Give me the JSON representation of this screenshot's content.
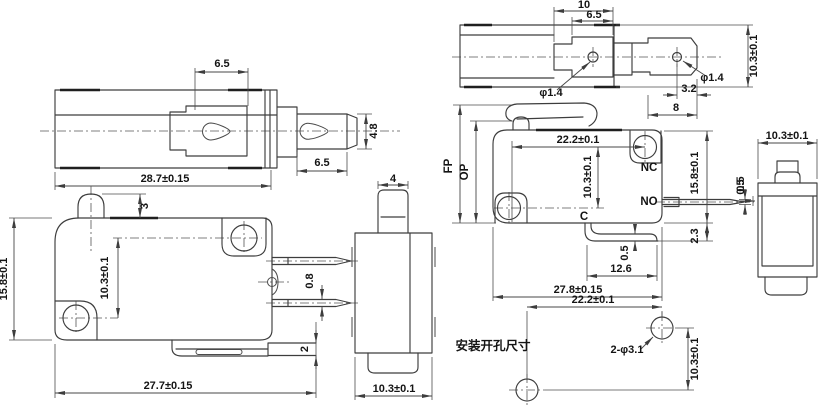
{
  "meta": {
    "type": "engineering-dimension-drawing",
    "subject": "micro switch (plunger and hinge-lever versions) multi-view drawing",
    "background_color": "#ffffff",
    "line_color": "#3d3d3d",
    "text_color": "#141414"
  },
  "views": {
    "plunger_top": {
      "dim_actuator_width": "6.5",
      "dim_shaft_height": "4.8",
      "dim_shaft_length": "6.5",
      "dim_body_length": "28.7±0.15"
    },
    "plunger_side": {
      "dim_button_height": "3",
      "dim_body_height": "15.8±0.1",
      "dim_hole_spacing": "10.3±0.1",
      "dim_terminal_thickness": "0.8",
      "dim_tab_thickness": "2",
      "dim_body_length": "27.7±0.15"
    },
    "plunger_end": {
      "dim_button_width": "4",
      "dim_body_width": "10.3±0.1"
    },
    "lever_top": {
      "dim_hinge_width": "10",
      "dim_hinge_inner_width": "6.5",
      "dim_hole_left": "φ1.4",
      "dim_hole_right": "φ1.4",
      "dim_hole_to_end": "3.2",
      "dim_arm_length": "8",
      "dim_body_width": "10.3±0.1"
    },
    "lever_side": {
      "label_fp": "FP",
      "label_op": "OP",
      "label_nc": "NC",
      "label_no": "NO",
      "label_c": "C",
      "dim_hole_spacing_h": "22.2±0.1",
      "dim_hole_spacing_v": "10.3±0.1",
      "dim_body_height": "15.8±0.1",
      "dim_terminal_thickness": "0.5",
      "dim_bracket_drop": "2.3",
      "dim_bracket_thickness": "0.5",
      "dim_bracket_length": "12.6",
      "dim_body_length": "27.8±0.15"
    },
    "lever_end": {
      "dim_body_width": "10.3±0.1",
      "dim_step": "0.5"
    },
    "mounting": {
      "caption": "安装开孔尺寸",
      "dim_hole_spacing_h": "22.2±0.1",
      "dim_hole_callout": "2-φ3.1",
      "dim_hole_spacing_v": "10.3±0.1"
    }
  }
}
